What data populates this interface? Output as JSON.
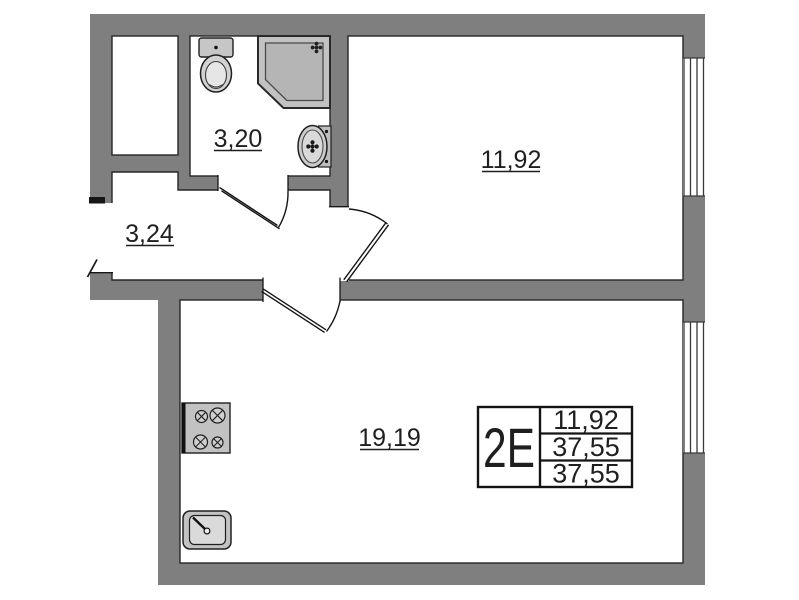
{
  "floor_plan": {
    "rooms": {
      "bathroom": {
        "area": "3,20"
      },
      "hallway": {
        "area": "3,24"
      },
      "bedroom": {
        "area": "11,92"
      },
      "living_kitchen": {
        "area": "19,19"
      }
    },
    "stamp": {
      "unit": "2E",
      "rows": [
        "11,92",
        "37,55",
        "37,55"
      ]
    },
    "fixtures": [
      "toilet",
      "shower-cabin",
      "washbasin",
      "stove",
      "kitchen-sink"
    ],
    "colors": {
      "wall": "#7f7f7f",
      "fixture": "#c2c2c2",
      "line": "#1f1f1f"
    }
  }
}
